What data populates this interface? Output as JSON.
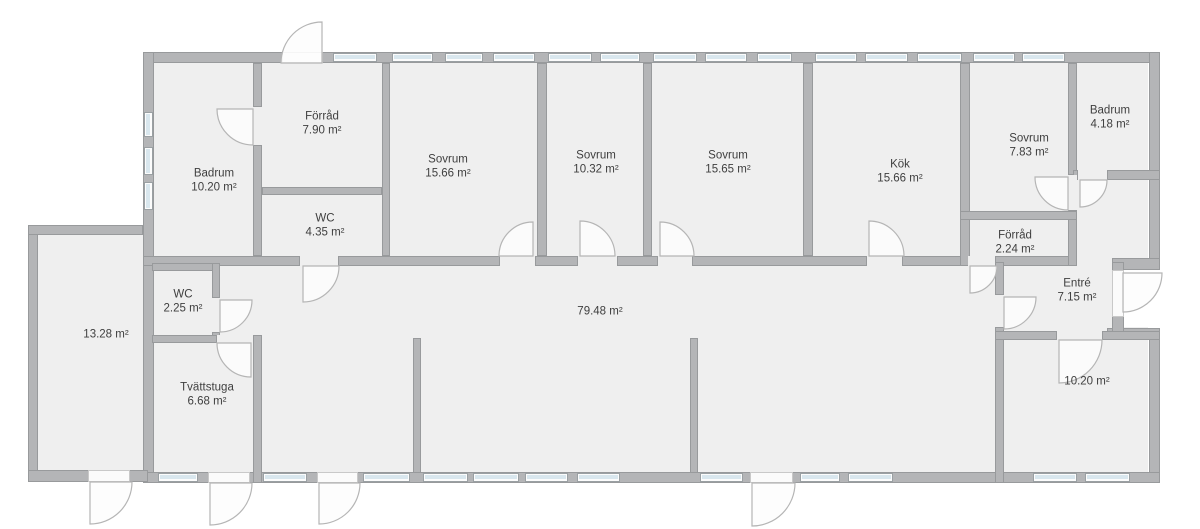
{
  "plan": {
    "title": "Floor plan",
    "unit": "m²",
    "rooms": [
      {
        "name": "Badrum",
        "area": "10.20 m²",
        "x": 214,
        "y": 181
      },
      {
        "name": "Förråd",
        "area": "7.90 m²",
        "x": 322,
        "y": 124
      },
      {
        "name": "WC",
        "area": "4.35 m²",
        "x": 325,
        "y": 226
      },
      {
        "name": "Sovrum",
        "area": "15.66 m²",
        "x": 448,
        "y": 167
      },
      {
        "name": "Sovrum",
        "area": "10.32 m²",
        "x": 596,
        "y": 163
      },
      {
        "name": "Sovrum",
        "area": "15.65 m²",
        "x": 728,
        "y": 163
      },
      {
        "name": "Kök",
        "area": "15.66 m²",
        "x": 900,
        "y": 172
      },
      {
        "name": "Sovrum",
        "area": "7.83 m²",
        "x": 1029,
        "y": 146
      },
      {
        "name": "Badrum",
        "area": "4.18 m²",
        "x": 1110,
        "y": 118
      },
      {
        "name": "Förråd",
        "area": "2.24 m²",
        "x": 1015,
        "y": 243
      },
      {
        "name": "Entré",
        "area": "7.15 m²",
        "x": 1077,
        "y": 291
      },
      {
        "name": "",
        "area": "79.48 m²",
        "x": 600,
        "y": 312
      },
      {
        "name": "",
        "area": "13.28 m²",
        "x": 106,
        "y": 335
      },
      {
        "name": "WC",
        "area": "2.25 m²",
        "x": 183,
        "y": 302
      },
      {
        "name": "Tvättstuga",
        "area": "6.68 m²",
        "x": 207,
        "y": 395
      },
      {
        "name": "",
        "area": "10.20 m²",
        "x": 1087,
        "y": 382
      }
    ],
    "colors": {
      "wall": "#b4b5b7",
      "room_fill": "#efefef",
      "window_glass": "#d9e7ee",
      "door_stroke": "#b5b5b5",
      "text": "#3f3f3f",
      "outside": "#ffffff"
    }
  }
}
